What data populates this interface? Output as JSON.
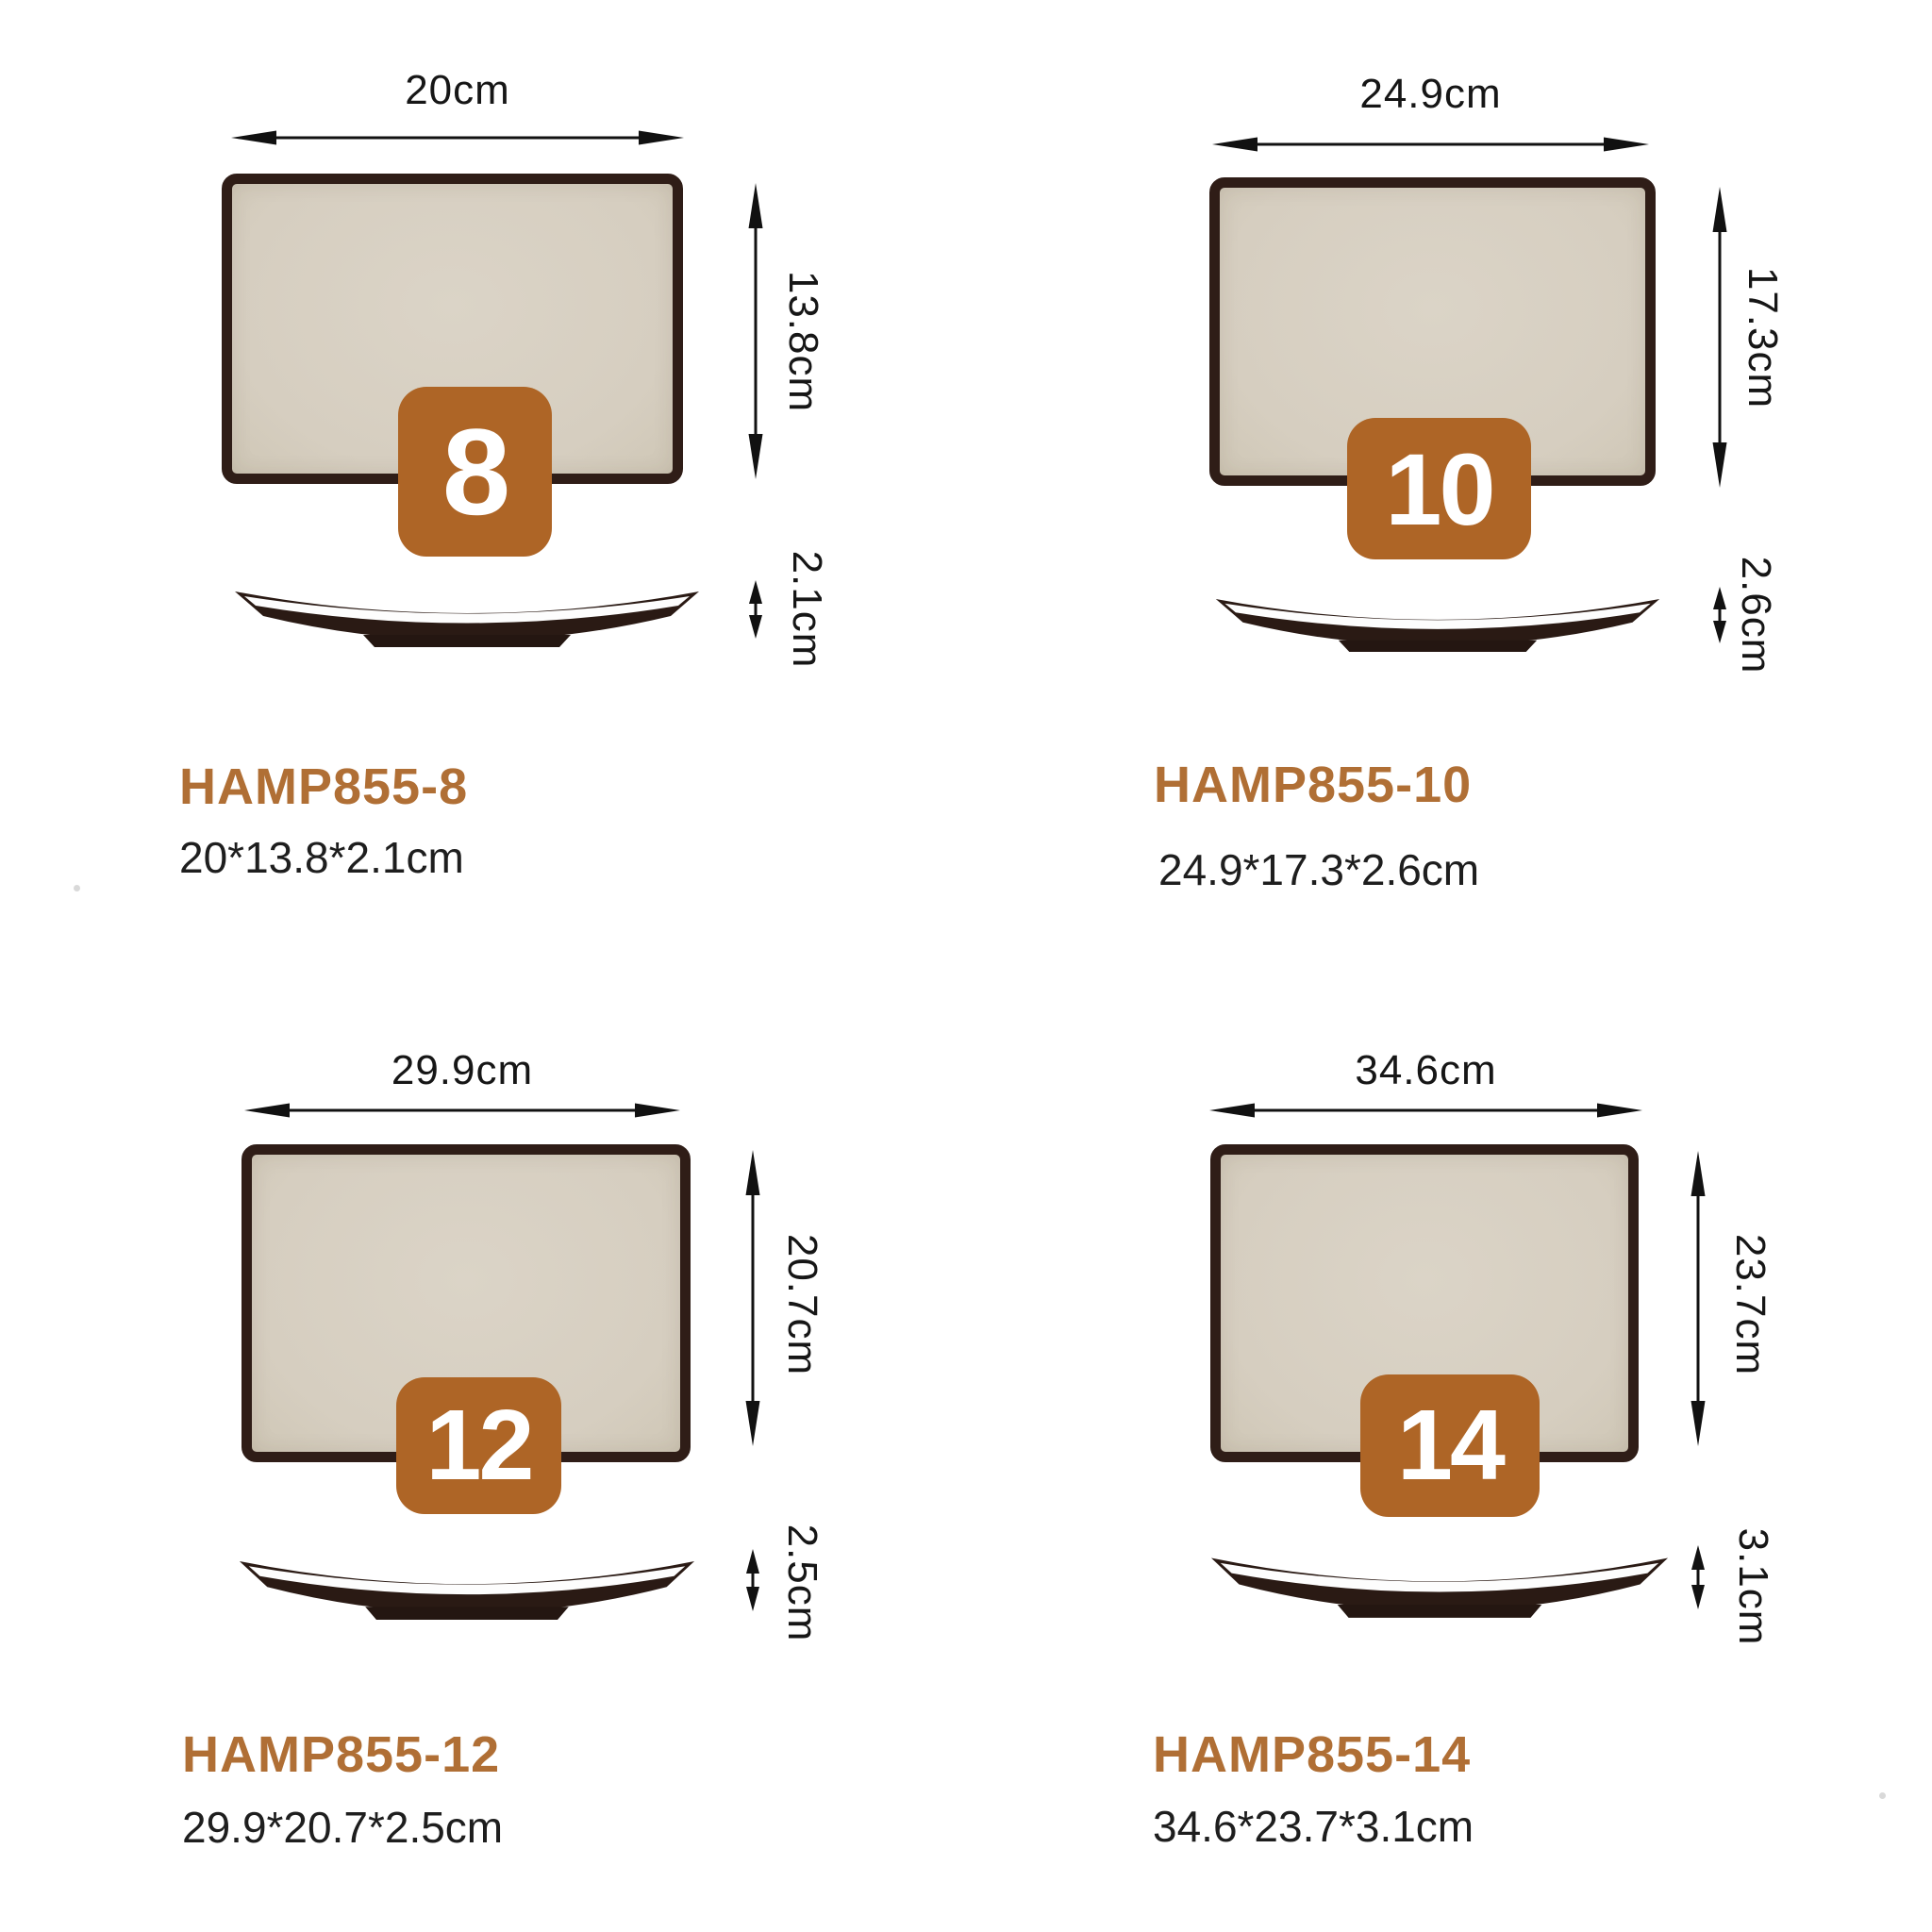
{
  "colors": {
    "badge-bg": "#ae6526",
    "title-color": "#b06f35",
    "beige": "#d6cec0",
    "dark-border": "#2f1d17",
    "side-dark": "#2a1a14",
    "text-dark": "#161616",
    "arrow-color": "#111111"
  },
  "products": [
    {
      "code": "HAMP855-8",
      "size_badge": "8",
      "width_label": "20cm",
      "height_label": "13.8cm",
      "thickness_label": "2.1cm",
      "dimensions": "20*13.8*2.1cm"
    },
    {
      "code": "HAMP855-10",
      "size_badge": "10",
      "width_label": "24.9cm",
      "height_label": "17.3cm",
      "thickness_label": "2.6cm",
      "dimensions": "24.9*17.3*2.6cm"
    },
    {
      "code": "HAMP855-12",
      "size_badge": "12",
      "width_label": "29.9cm",
      "height_label": "20.7cm",
      "thickness_label": "2.5cm",
      "dimensions": "29.9*20.7*2.5cm"
    },
    {
      "code": "HAMP855-14",
      "size_badge": "14",
      "width_label": "34.6cm",
      "height_label": "23.7cm",
      "thickness_label": "3.1cm",
      "dimensions": "34.6*23.7*3.1cm"
    }
  ]
}
